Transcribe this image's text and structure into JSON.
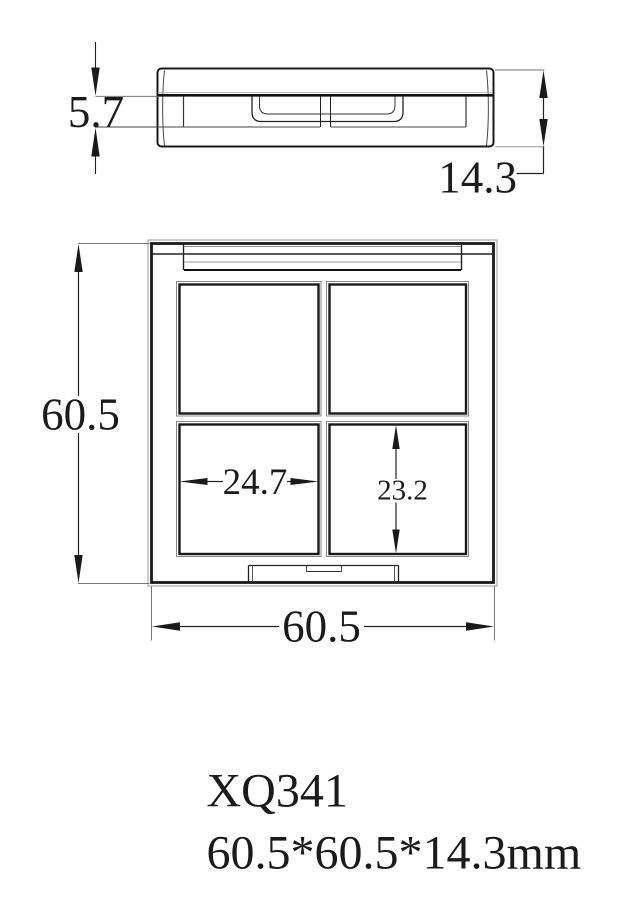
{
  "drawing": {
    "caption": {
      "model": "XQ341",
      "size": "60.5*60.5*14.3mm"
    },
    "side_view": {
      "lid_thickness": "5.7",
      "total_thickness": "14.3"
    },
    "front_view": {
      "overall_height": "60.5",
      "overall_width": "60.5",
      "pan_width": "24.7",
      "pan_height": "23.2"
    }
  }
}
